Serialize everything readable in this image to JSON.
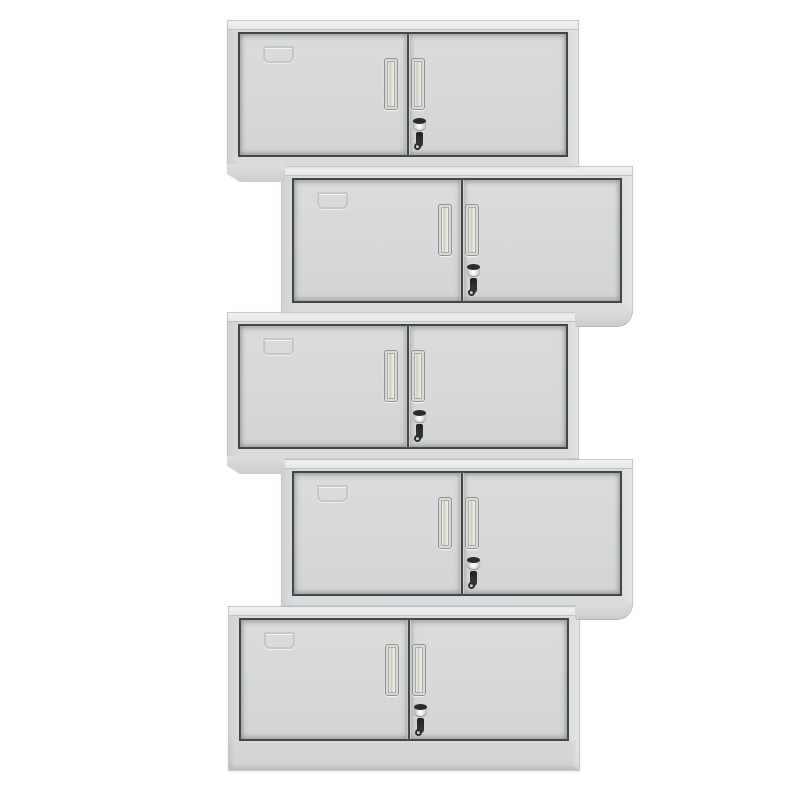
{
  "canvas": {
    "width": 800,
    "height": 800,
    "background": "#ffffff"
  },
  "product": {
    "name": "stacked-two-door-steel-wall-cabinets",
    "unit_count": 5,
    "arrangement": "vertical zigzag stack, rows 1/3/5 aligned left, rows 2/4 offset right"
  },
  "cabinet_features": {
    "doors_per_cabinet": 2,
    "handles_per_cabinet": 2,
    "handle_style": "vertical recessed",
    "lock_with_hanging_key": true,
    "label_card_holder_on_left_door": true,
    "bottom_unit_has_plinth_base": true
  },
  "cabinets": [
    {
      "index": 1,
      "x": 227,
      "y": 20,
      "width": 352,
      "height": 147,
      "variant": "standard",
      "foot_side": "left"
    },
    {
      "index": 2,
      "x": 281,
      "y": 166,
      "width": 352,
      "height": 147,
      "variant": "standard",
      "foot_side": "right"
    },
    {
      "index": 3,
      "x": 227,
      "y": 312,
      "width": 352,
      "height": 147,
      "variant": "standard",
      "foot_side": "left"
    },
    {
      "index": 4,
      "x": 281,
      "y": 459,
      "width": 352,
      "height": 147,
      "variant": "standard",
      "foot_side": "right"
    },
    {
      "index": 5,
      "x": 228,
      "y": 606,
      "width": 352,
      "height": 165,
      "variant": "base",
      "foot_side": "none"
    }
  ],
  "colors": {
    "background": "#ffffff",
    "body": "#d9dbdc",
    "cap": "#e5e7e8",
    "frame": "#434648",
    "door": "#d7d9d8",
    "handleFace": "#efeee6",
    "handleBorder": "#8e9193",
    "metalDark": "#2a2c2e",
    "labelLine": "#c3c6c7",
    "footShade": "#b5b8ba",
    "plinth": "#d6d8d9"
  }
}
